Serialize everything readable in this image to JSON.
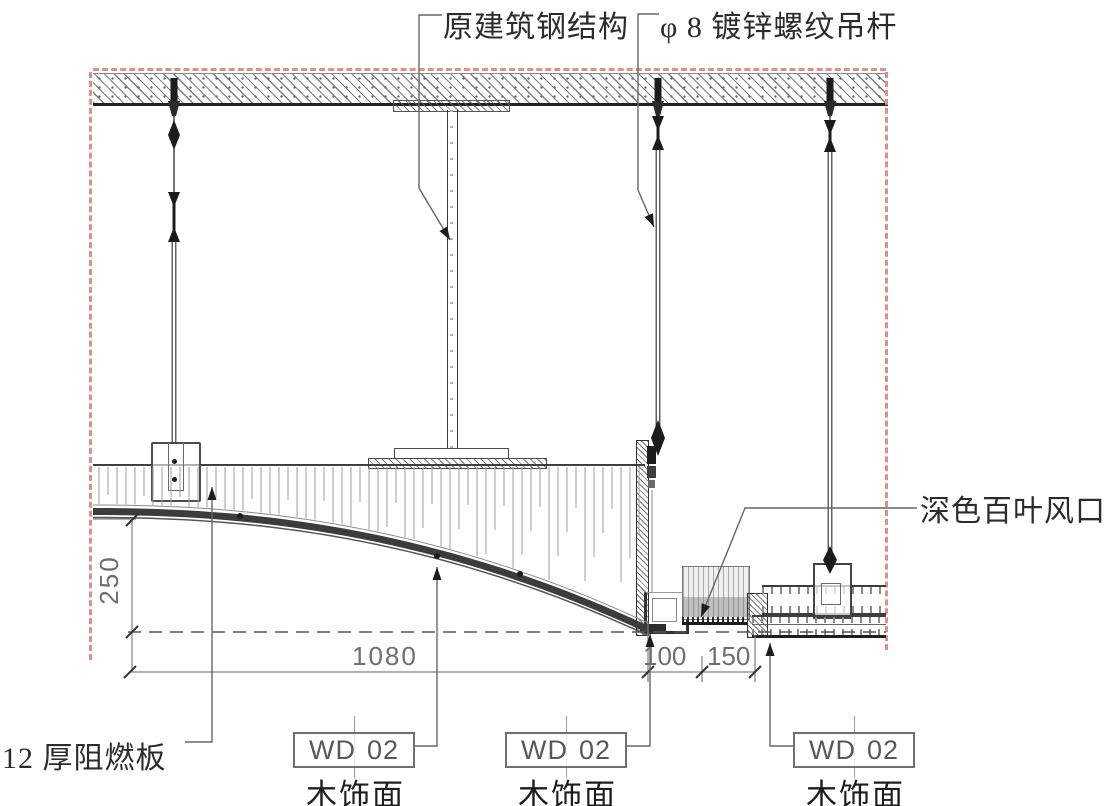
{
  "title_labels": {
    "steel_structure": "原建筑钢结构",
    "hanger_rod": "φ 8 镀锌螺纹吊杆"
  },
  "side_labels": {
    "louver_vent": "深色百叶风口",
    "fire_board": "12 厚阻燃板"
  },
  "dimensions": {
    "drop_height": "250",
    "curve_span": "1080",
    "vent_offset": "100",
    "vent_width": "150"
  },
  "finish_tags": [
    {
      "code": "WD",
      "number": "02",
      "caption": "木饰面"
    },
    {
      "code": "WD",
      "number": "02",
      "caption": "木饰面"
    },
    {
      "code": "WD",
      "number": "02",
      "caption": "木饰面"
    }
  ],
  "colors": {
    "red_dash": "#dd8f8f",
    "line_dark": "#2f2f2f",
    "line_mid": "#555555",
    "line_light": "#999999",
    "dim_text": "#6e6e6e"
  }
}
